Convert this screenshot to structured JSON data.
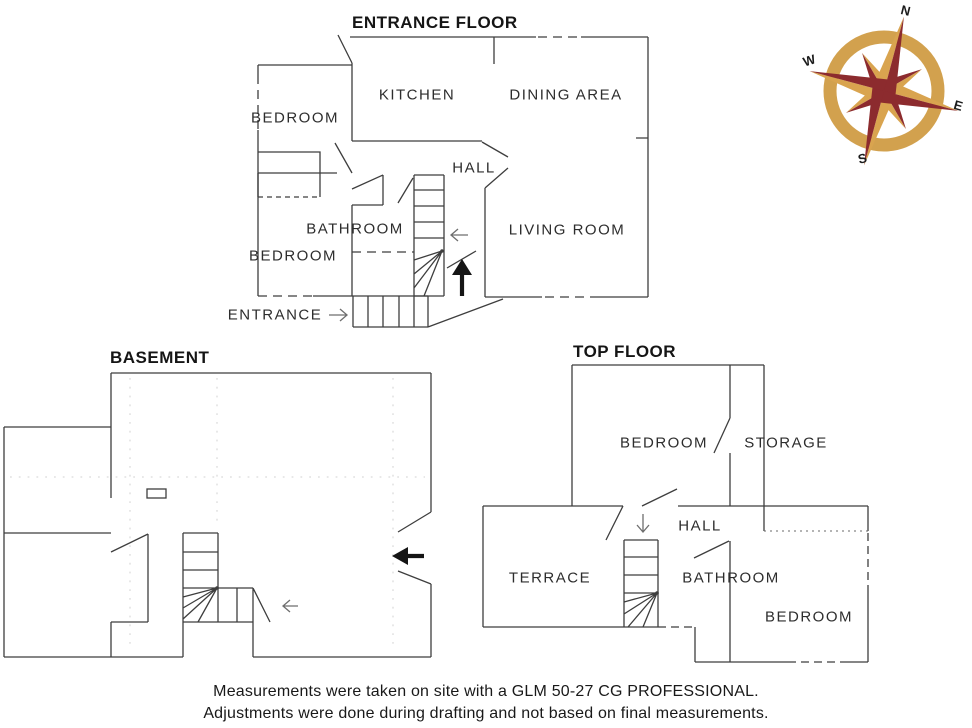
{
  "entrance_floor": {
    "title": "ENTRANCE FLOOR",
    "labels": {
      "bedroom_top": "BEDROOM",
      "kitchen": "KITCHEN",
      "dining_area": "DINING AREA",
      "hall": "HALL",
      "bathroom": "BATHROOM",
      "bedroom_bottom": "BEDROOM",
      "living_room": "LIVING ROOM",
      "entrance": "ENTRANCE"
    }
  },
  "basement": {
    "title": "BASEMENT"
  },
  "top_floor": {
    "title": "TOP FLOOR",
    "labels": {
      "bedroom_top": "BEDROOM",
      "storage": "STORAGE",
      "hall": "HALL",
      "terrace": "TERRACE",
      "bathroom": "BATHROOM",
      "bedroom_bottom": "BEDROOM"
    }
  },
  "compass": {
    "north": "N",
    "east": "E",
    "south": "S",
    "west": "W",
    "ring_color": "#D2A14E",
    "dark_color": "#8C2B2E",
    "light_color": "#D9A44F"
  },
  "notes": {
    "line1": "Measurements were taken on site with a GLM 50-27 CG PROFESSIONAL.",
    "line2": "Adjustments were done during drafting and not based on final measurements."
  }
}
